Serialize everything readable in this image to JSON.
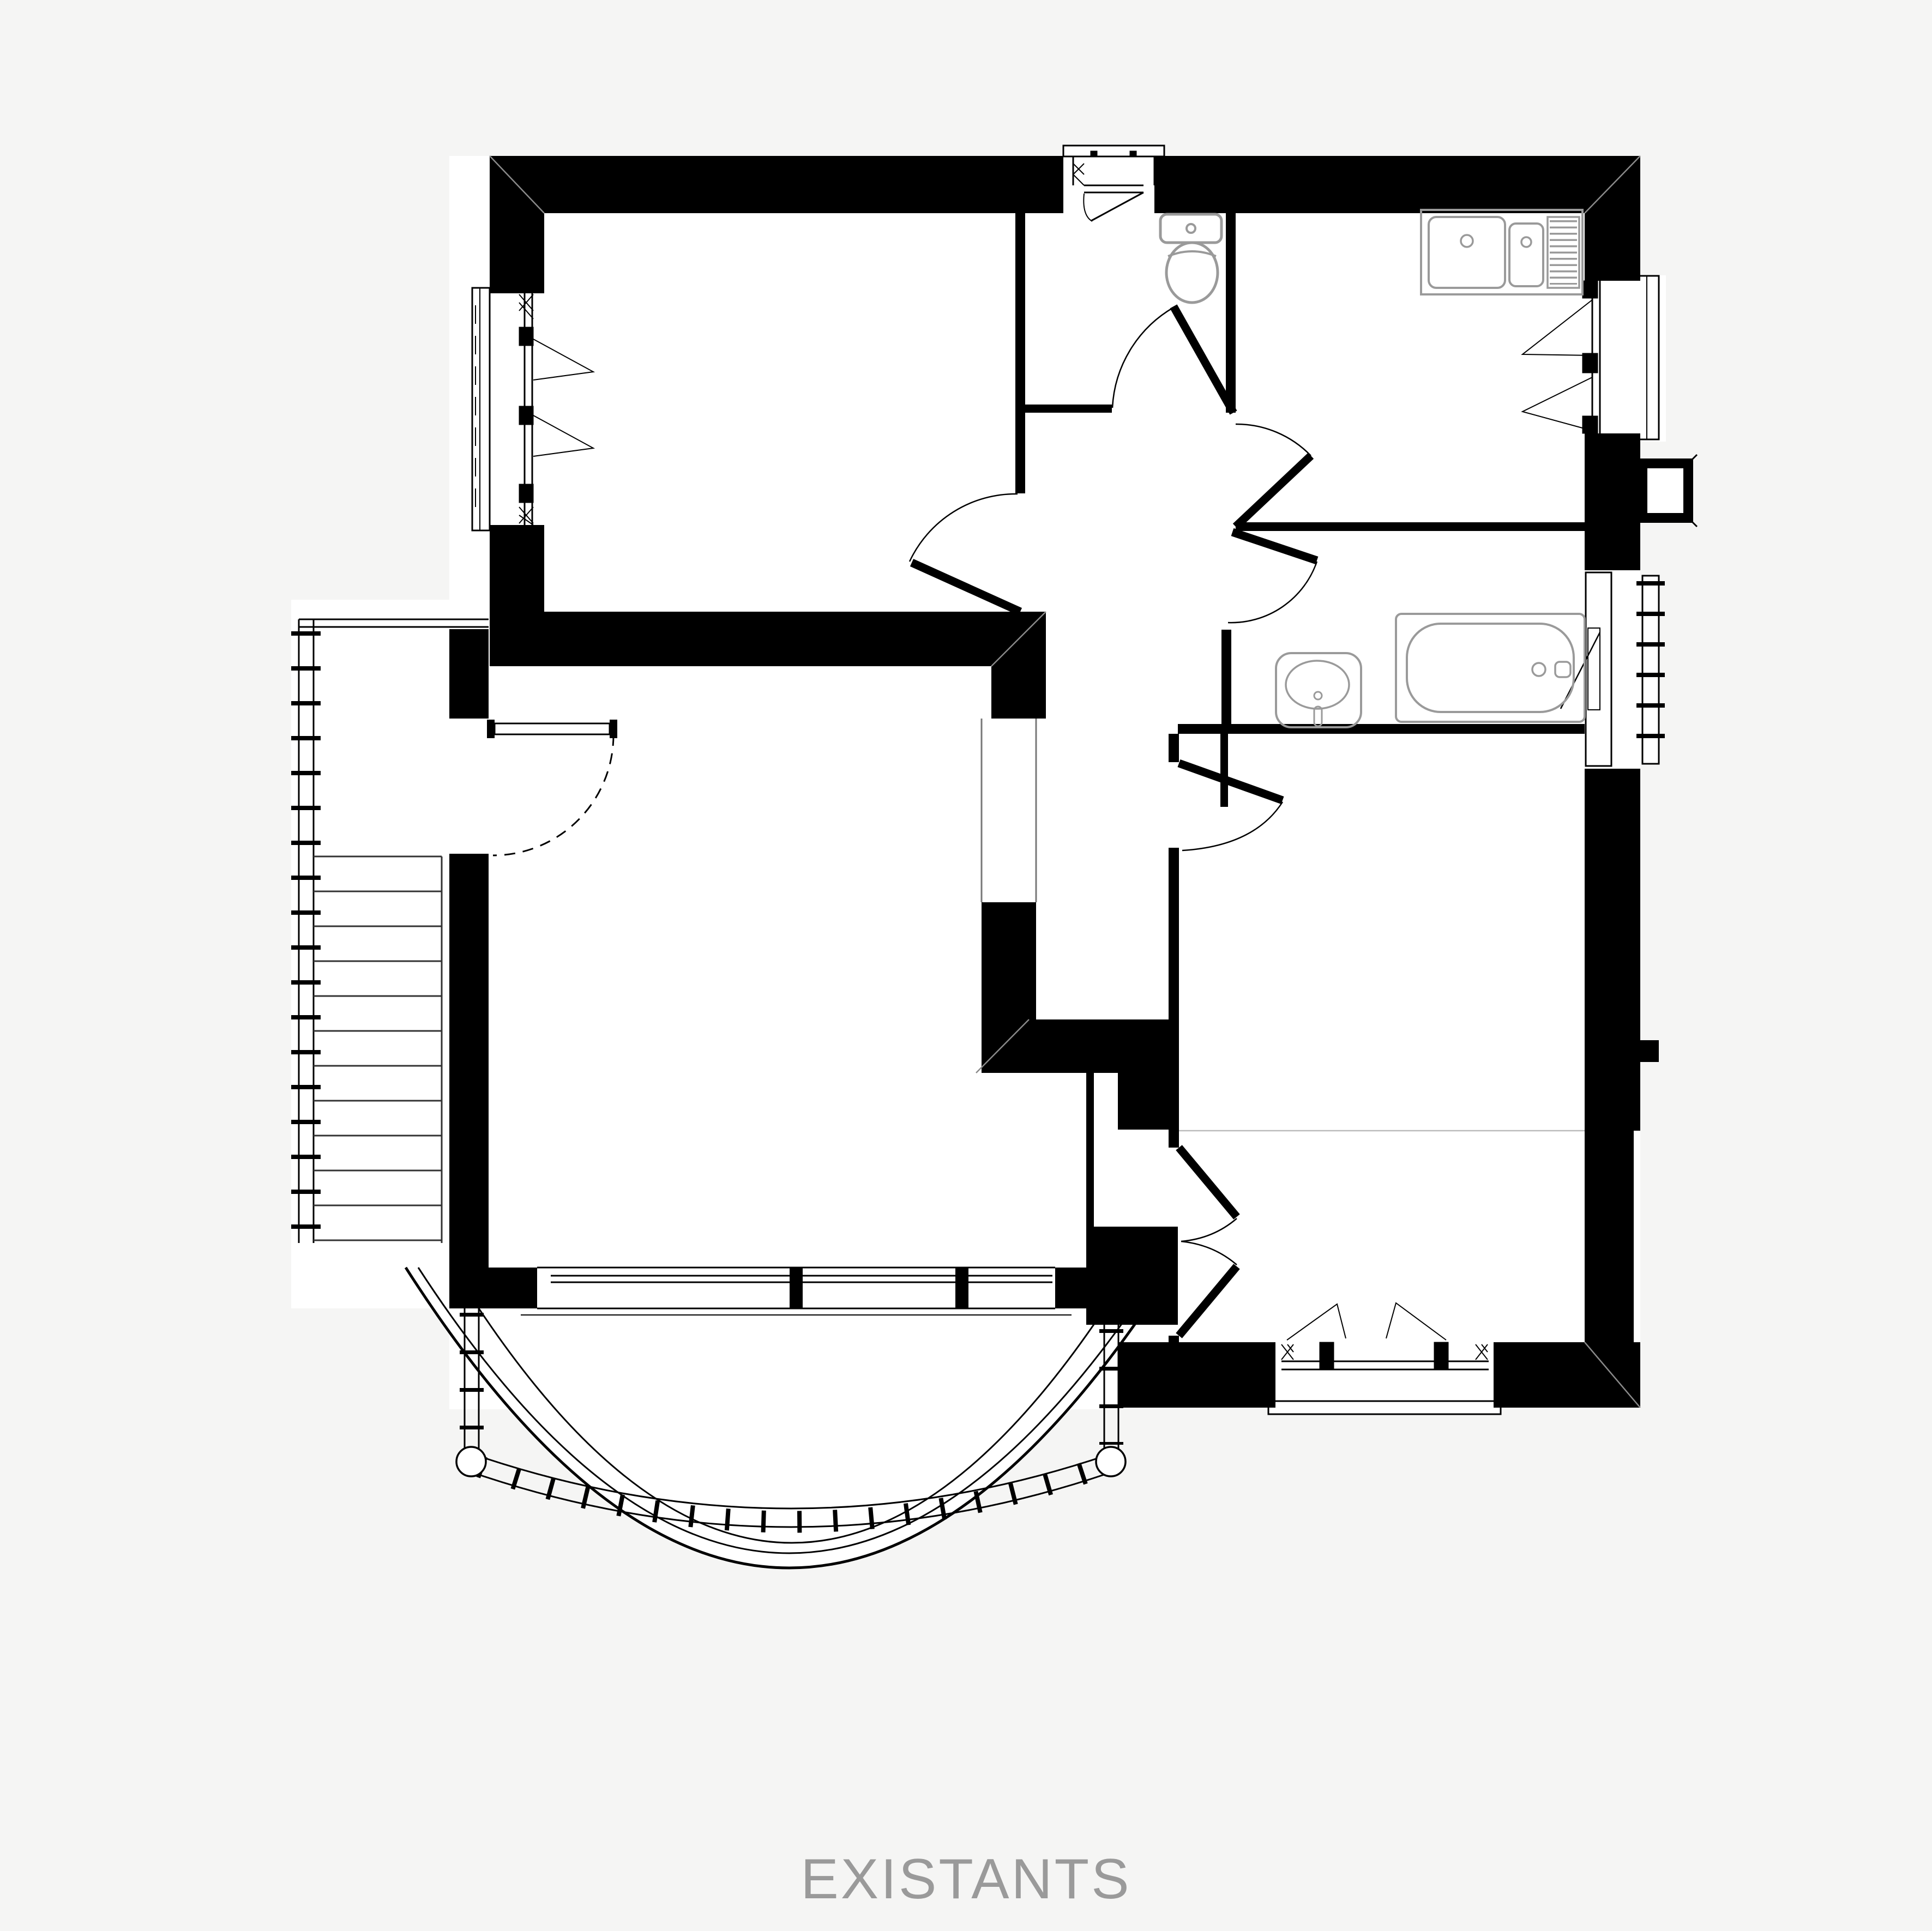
{
  "title": {
    "label": "EXISTANTS"
  },
  "drawing": {
    "kind": "architectural floor plan (existing state)",
    "language": "French",
    "floor_label": "EXISTANTS"
  },
  "colors": {
    "background": "#f5f5f4",
    "room_fill": "#ffffff",
    "wall": "#000000",
    "fixture_stroke": "#9a9a9a",
    "title_text": "#9a9a9a",
    "faint_line": "#bbbbbb"
  },
  "fixtures": [
    "toilet",
    "kitchen-double-sink-with-drainer",
    "washbasin",
    "bathtub",
    "radiator",
    "staircase",
    "bow-window-balcony-railing"
  ],
  "rooms": [
    "bedroom-top-left",
    "wc",
    "kitchen",
    "hall",
    "bathroom",
    "living-room",
    "bedroom-bottom-right",
    "stair-landing",
    "closets"
  ]
}
